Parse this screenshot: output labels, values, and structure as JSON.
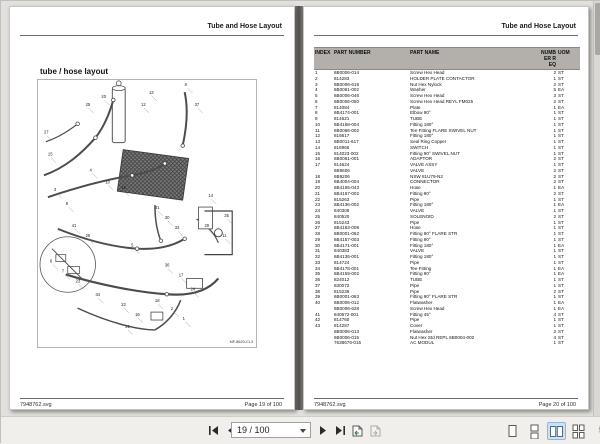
{
  "left_page": {
    "header": "Tube and Hose Layout",
    "title": "tube / hose layout",
    "diagram_label": "MF-8620-CL3",
    "footer_left": "7948762.svg",
    "footer_right": "Page 19 of 100"
  },
  "right_page": {
    "header": "Tube and Hose Layout",
    "footer_left": "7948762.svg",
    "footer_right": "Page 20 of 100",
    "table": {
      "columns": [
        "INDEX",
        "PART NUMBER",
        "PART NAME",
        "NUMBER REQ",
        "UOM"
      ],
      "rows": [
        [
          "1",
          "6B0006-014",
          "Screw Hex Head",
          "2",
          "ST"
        ],
        [
          "2",
          "814283",
          "HOLDER PLATE CONTACTOR",
          "1",
          "ST"
        ],
        [
          "3",
          "6B0006-618",
          "Nut Hex Nylock",
          "2",
          "ST"
        ],
        [
          "4",
          "6B0061-002",
          "Washer",
          "5",
          "EA"
        ],
        [
          "5",
          "6B0006-046",
          "Screw Hex Head",
          "3",
          "ST"
        ],
        [
          "6",
          "6B0006-050",
          "Screw Hex Head REYL FM025",
          "2",
          "ST"
        ],
        [
          "7",
          "814084",
          "Plate",
          "1",
          "EA"
        ],
        [
          "8",
          "6B4174-001",
          "Elbow 90°",
          "1",
          "ST"
        ],
        [
          "9",
          "814621",
          "TUBE",
          "1",
          "ST"
        ],
        [
          "10",
          "6B4168-004",
          "Fitting 180°",
          "1",
          "ST"
        ],
        [
          "11",
          "6B0066-002",
          "Tee Fitting FLARE SWIVEL NUT",
          "1",
          "ST"
        ],
        [
          "12",
          "816617",
          "Fitting 180°",
          "1",
          "ST"
        ],
        [
          "13",
          "6B0011-617",
          "Seal Ring Copper",
          "1",
          "ST"
        ],
        [
          "14",
          "816966",
          "SWITCH",
          "1",
          "ST"
        ],
        [
          "15",
          "814023-002",
          "Fitting 90° SWIVEL NUT",
          "1",
          "ST"
        ],
        [
          "16",
          "6B0061-001",
          "ADAPTOR",
          "2",
          "ST"
        ],
        [
          "17",
          "814624",
          "VALVE ASSY",
          "1",
          "ST"
        ],
        [
          "",
          "6B9606",
          "VALVE",
          "2",
          "ST"
        ],
        [
          "18",
          "6B9206",
          "NSW 81U79-N2",
          "2",
          "ST"
        ],
        [
          "19",
          "6B4004-004",
          "CONNECTOR",
          "2",
          "ST"
        ],
        [
          "20",
          "6B4165-043",
          "Hose",
          "1",
          "EA"
        ],
        [
          "21",
          "6B4167-002",
          "Fitting 90°",
          "2",
          "ST"
        ],
        [
          "22",
          "815263",
          "Pipe",
          "1",
          "ST"
        ],
        [
          "23",
          "6B4136-002",
          "Fitting 180°",
          "1",
          "EA"
        ],
        [
          "24",
          "840306",
          "VALVE",
          "1",
          "ST"
        ],
        [
          "25",
          "840520",
          "SOLENOID",
          "2",
          "ST"
        ],
        [
          "26",
          "815243",
          "Pipe",
          "1",
          "ST"
        ],
        [
          "27",
          "6B4163-008",
          "Hose",
          "1",
          "ST"
        ],
        [
          "28",
          "6B0001-062",
          "Fitting 90° FLARE STR",
          "1",
          "ST"
        ],
        [
          "29",
          "6B4157-003",
          "Fitting 90°",
          "1",
          "ST"
        ],
        [
          "30",
          "6B4171-001",
          "Fitting 180°",
          "1",
          "EA"
        ],
        [
          "31",
          "840383",
          "VALVE",
          "1",
          "ST"
        ],
        [
          "32",
          "6B4136-001",
          "Fitting 180°",
          "1",
          "ST"
        ],
        [
          "33",
          "814724",
          "Pipe",
          "1",
          "ST"
        ],
        [
          "34",
          "6B4178-001",
          "Tee Fitting",
          "1",
          "EA"
        ],
        [
          "35",
          "6B4159-002",
          "Fitting 90°",
          "1",
          "EA"
        ],
        [
          "36",
          "824012",
          "TUBE",
          "1",
          "ST"
        ],
        [
          "37",
          "830072",
          "Pipe",
          "1",
          "ST"
        ],
        [
          "38",
          "815236",
          "Pipe",
          "2",
          "ST"
        ],
        [
          "39",
          "6B0001-063",
          "Fitting 90° FLARE STR",
          "1",
          "ST"
        ],
        [
          "40",
          "6B0006-012",
          "Flatwasher",
          "1",
          "EA"
        ],
        [
          "",
          "6B0006-628",
          "Screw Hex Head",
          "1",
          "EA"
        ],
        [
          "41",
          "840672-001",
          "Fitting 45°",
          "4",
          "ST"
        ],
        [
          "42",
          "814760",
          "Pipe",
          "1",
          "ST"
        ],
        [
          "43",
          "814287",
          "Cover",
          "1",
          "ST"
        ],
        [
          "",
          "6B0006-013",
          "Flatwasher",
          "2",
          "ST"
        ],
        [
          "",
          "6B0006-015",
          "Nut Hex Std REPL 6B0004-002",
          "4",
          "ST"
        ],
        [
          "",
          "7638676-015",
          "AC MODUL",
          "1",
          "ST"
        ]
      ]
    }
  },
  "diagram": {
    "callouts": [
      {
        "n": "20",
        "x": 64,
        "y": 18
      },
      {
        "n": "25",
        "x": 48,
        "y": 26
      },
      {
        "n": "13",
        "x": 112,
        "y": 14
      },
      {
        "n": "12",
        "x": 104,
        "y": 26
      },
      {
        "n": "8",
        "x": 148,
        "y": 6
      },
      {
        "n": "37",
        "x": 158,
        "y": 26
      },
      {
        "n": "27",
        "x": 6,
        "y": 54
      },
      {
        "n": "15",
        "x": 10,
        "y": 76
      },
      {
        "n": "4",
        "x": 52,
        "y": 92
      },
      {
        "n": "10",
        "x": 68,
        "y": 104
      },
      {
        "n": "19",
        "x": 84,
        "y": 110
      },
      {
        "n": "3",
        "x": 16,
        "y": 112
      },
      {
        "n": "9",
        "x": 28,
        "y": 126
      },
      {
        "n": "31",
        "x": 118,
        "y": 130
      },
      {
        "n": "30",
        "x": 128,
        "y": 140
      },
      {
        "n": "33",
        "x": 138,
        "y": 150
      },
      {
        "n": "41",
        "x": 34,
        "y": 148
      },
      {
        "n": "26",
        "x": 48,
        "y": 158
      },
      {
        "n": "14",
        "x": 172,
        "y": 118
      },
      {
        "n": "35",
        "x": 188,
        "y": 138
      },
      {
        "n": "29",
        "x": 168,
        "y": 148
      },
      {
        "n": "11",
        "x": 186,
        "y": 158
      },
      {
        "n": "5",
        "x": 94,
        "y": 168
      },
      {
        "n": "6",
        "x": 12,
        "y": 184
      },
      {
        "n": "7",
        "x": 24,
        "y": 194
      },
      {
        "n": "23",
        "x": 38,
        "y": 204
      },
      {
        "n": "36",
        "x": 128,
        "y": 188
      },
      {
        "n": "17",
        "x": 142,
        "y": 198
      },
      {
        "n": "24",
        "x": 154,
        "y": 212
      },
      {
        "n": "34",
        "x": 58,
        "y": 218
      },
      {
        "n": "22",
        "x": 84,
        "y": 228
      },
      {
        "n": "18",
        "x": 118,
        "y": 224
      },
      {
        "n": "2",
        "x": 134,
        "y": 232
      },
      {
        "n": "1",
        "x": 146,
        "y": 242
      },
      {
        "n": "16",
        "x": 98,
        "y": 238
      },
      {
        "n": "21",
        "x": 88,
        "y": 250
      }
    ]
  },
  "toolbar": {
    "page_field_value": "19 / 100",
    "zoom_text_clipped": "5",
    "icons": {
      "first_page": "first-page-icon",
      "previous_page": "previous-page-icon",
      "next_page": "next-page-icon",
      "last_page": "last-page-icon",
      "previous_view": "previous-view-icon",
      "next_view": "next-view-icon",
      "single_page_view": "single-page-view-icon",
      "continuous_view": "continuous-view-icon",
      "facing_view": "facing-view-icon",
      "facing_continuous_view": "facing-continuous-view-icon"
    }
  }
}
